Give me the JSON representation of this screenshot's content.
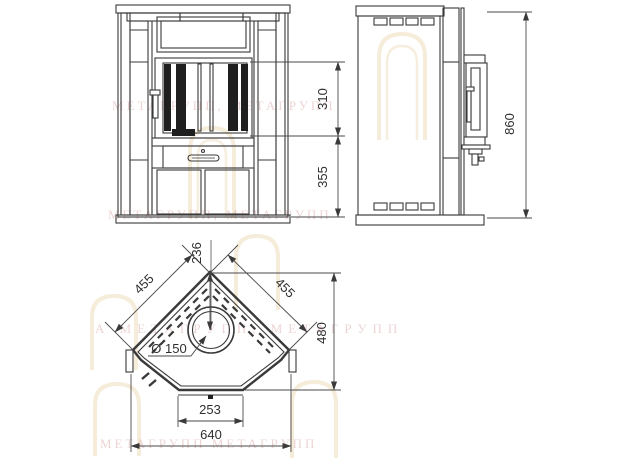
{
  "colors": {
    "background": "#ffffff",
    "line": "#3a3a3a",
    "dim_line": "#4a4a4a",
    "text": "#2f2f2f",
    "dark_fill": "#1f1f1f",
    "watermark_text": "#cf9090",
    "watermark_logo": "#e8d5ad"
  },
  "watermark": {
    "rows": [
      "МЕТАГРУПП, МЕТАГРУПП",
      "МЕТАГРУПП, МЕТАГРУПП",
      "А МЕТАГРУПП, МЕТАГРУПП",
      "МЕТАГРУПП МЕТАГРУПП"
    ]
  },
  "views": {
    "front": {
      "dims": {
        "firebox_height": "310",
        "base_height": "355"
      }
    },
    "side": {
      "dims": {
        "overall_height": "860"
      }
    },
    "top": {
      "dims": {
        "back_to_flue_center": "236",
        "left_side": "455",
        "right_side": "455",
        "depth": "480",
        "flue_diameter": "Ø 150",
        "front_panel_width": "253",
        "overall_width": "640"
      }
    }
  }
}
